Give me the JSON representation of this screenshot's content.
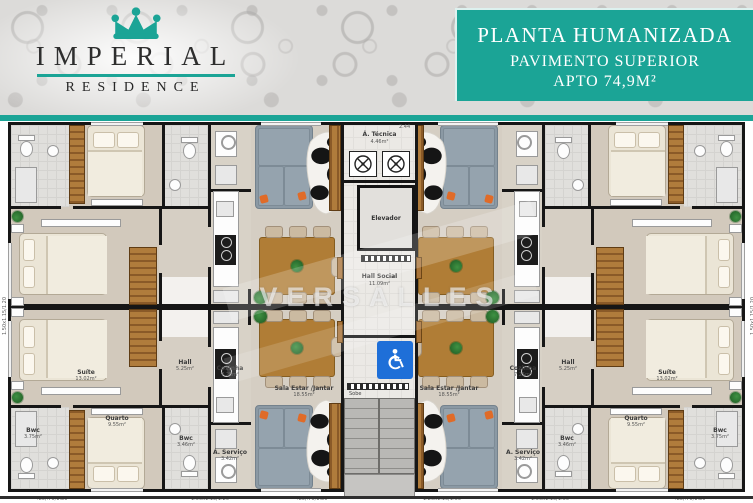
{
  "brand": {
    "name": "IMPERIAL",
    "subtitle": "RESIDENCE"
  },
  "header": {
    "title": "PLANTA HUMANIZADA",
    "subtitle1": "PAVIMENTO SUPERIOR",
    "subtitle2": "APTO 74,9M²"
  },
  "watermark": "VERSALLES",
  "core": {
    "tecnica": {
      "name": "Á. Técnica",
      "area": "4.46m²"
    },
    "elevator": {
      "name": "Elevador"
    },
    "hall_social": {
      "name": "Hall Social",
      "area": "11.09m²"
    },
    "stairs": {
      "label": "Sobe"
    }
  },
  "rooms": {
    "suite": {
      "name": "Suíte",
      "area": "13.02m²"
    },
    "hall": {
      "name": "Hall",
      "area": "5.25m²"
    },
    "quarto": {
      "name": "Quarto",
      "area": "9.55m²"
    },
    "bwc1": {
      "name": "Bwc",
      "area": "3.75m²"
    },
    "bwc2": {
      "name": "Bwc",
      "area": "3.46m²"
    },
    "cozinha": {
      "name": "Cozinha",
      "area": "7.25m²"
    },
    "servico": {
      "name": "Á. Serviço",
      "area": "3.42m²"
    },
    "sala": {
      "name": "Sala Estar /Jantar",
      "area": "18.55m²"
    }
  },
  "dimensions": {
    "top": "2.44",
    "side": "1.50x1.15/1.20",
    "bottom": [
      ".80/.70/1.80",
      "1.50x1.15/1.20",
      ".80/.70/1.80",
      "1.20x1.10/1.05",
      "1.50x1.10/1.00",
      ".80/.70/1.80"
    ]
  },
  "colors": {
    "teal": "#1BA496",
    "wall": "#161616",
    "access_blue": "#1E6FD8",
    "wood": "#A9743A"
  }
}
